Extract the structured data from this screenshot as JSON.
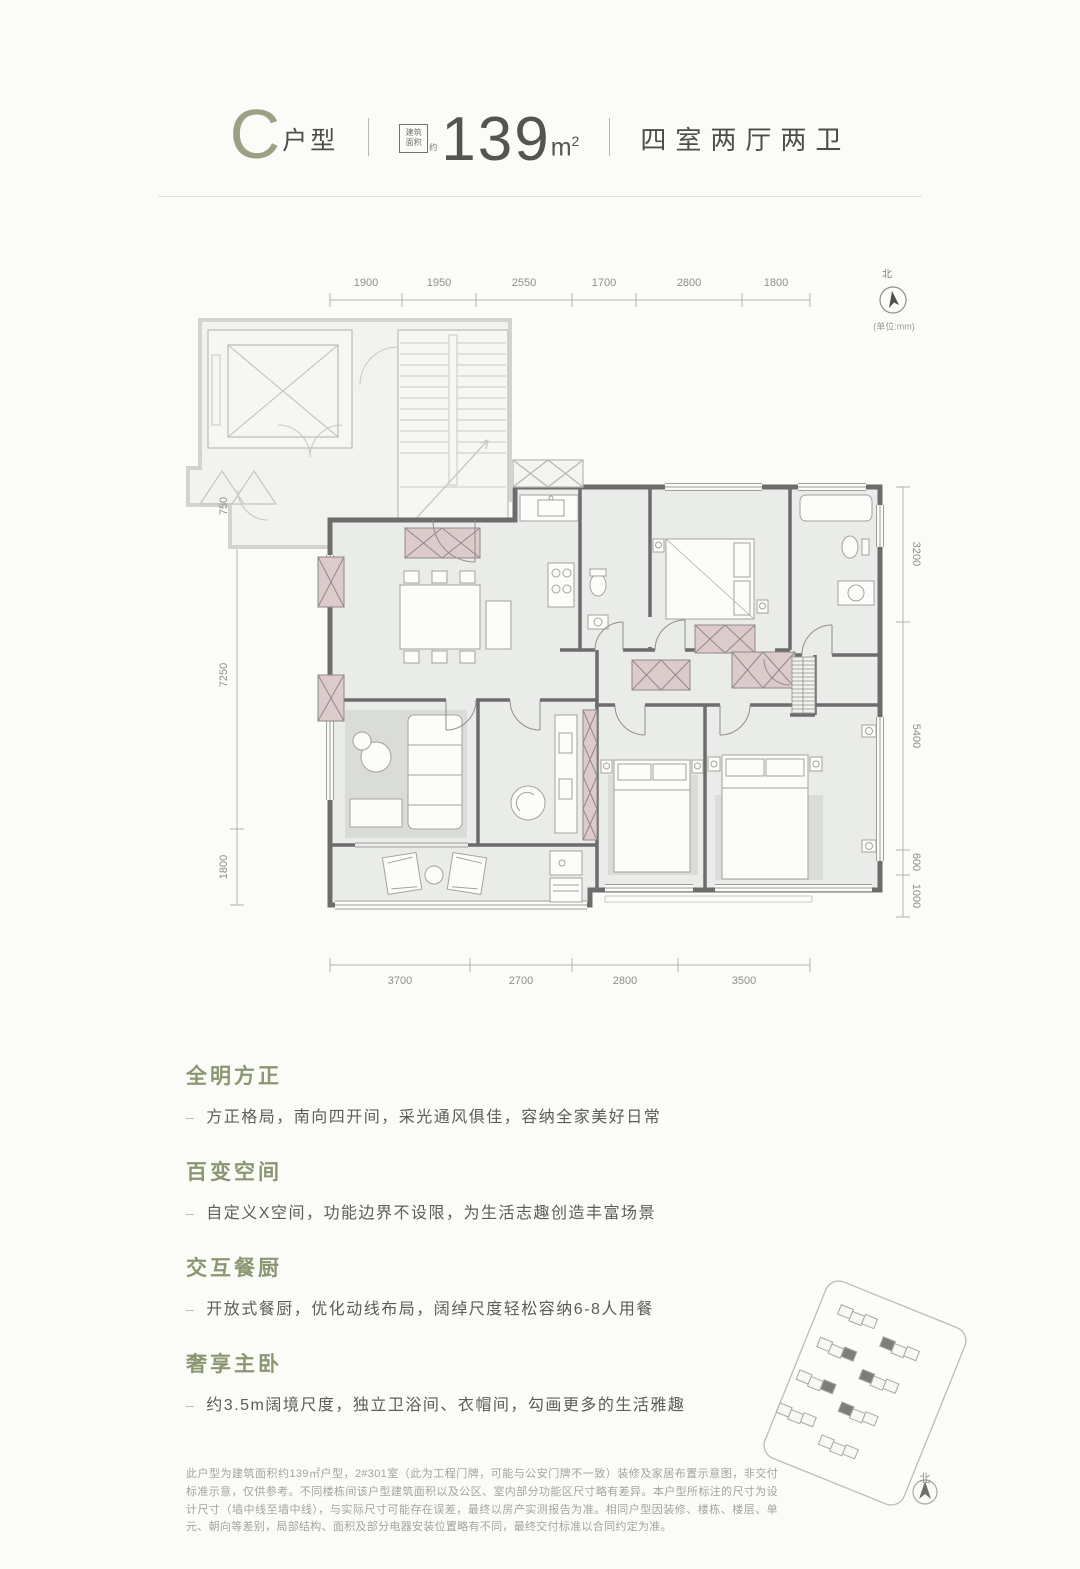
{
  "header": {
    "type_letter": "C",
    "type_label": "户型",
    "stamp_line1": "建筑",
    "stamp_line2": "面积",
    "stamp_suffix": "约",
    "area_value": "139",
    "area_unit": "m",
    "area_unit_exp": "2",
    "layout_label": "四室两厅两卫"
  },
  "plan": {
    "compass_label": "北",
    "unit_note": "(单位:mm)",
    "dims": {
      "top": [
        "1900",
        "1950",
        "2550",
        "1700",
        "2800",
        "1800"
      ],
      "bottom": [
        "3700",
        "2700",
        "2800",
        "3500"
      ],
      "left": [
        "750",
        "7250",
        "1800"
      ],
      "right": [
        "3200",
        "5400",
        "600",
        "1000"
      ]
    }
  },
  "features_bullet": "–",
  "features": [
    {
      "title": "全明方正",
      "desc": "方正格局，南向四开间，采光通风俱佳，容纳全家美好日常"
    },
    {
      "title": "百变空间",
      "desc": "自定义X空间，功能边界不设限，为生活志趣创造丰富场景"
    },
    {
      "title": "交互餐厨",
      "desc": "开放式餐厨，优化动线布局，阔绰尺度轻松容纳6-8人用餐"
    },
    {
      "title": "奢享主卧",
      "desc": "约3.5m阔境尺度，独立卫浴间、衣帽间，勾画更多的生活雅趣"
    }
  ],
  "disclaimer": "此户型为建筑面积约139㎡户型，2#301室（此为工程门牌，可能与公安门牌不一致）装修及家居布置示意图，非交付标准示意，仅供参考。不同楼栋间该户型建筑面积以及公区、室内部分功能区尺寸略有差异。本户型所标注的尺寸为设计尺寸（墙中线至墙中线），与实际尺寸可能存在误差，最终以房产实测报告为准。相同户型因装修、楼栋、楼层、单元、朝向等差别，局部结构、面积及部分电器安装位置略有不同，最终交付标准以合同约定为准。",
  "siteplan": {
    "compass_label": "北"
  },
  "colors": {
    "accent_green": "#8a9772",
    "wall_dark": "#6c6c6c",
    "cabinet_pink": "#dccbca",
    "floor_fill": "#eaece9",
    "page_bg": "#fbfbf8"
  }
}
